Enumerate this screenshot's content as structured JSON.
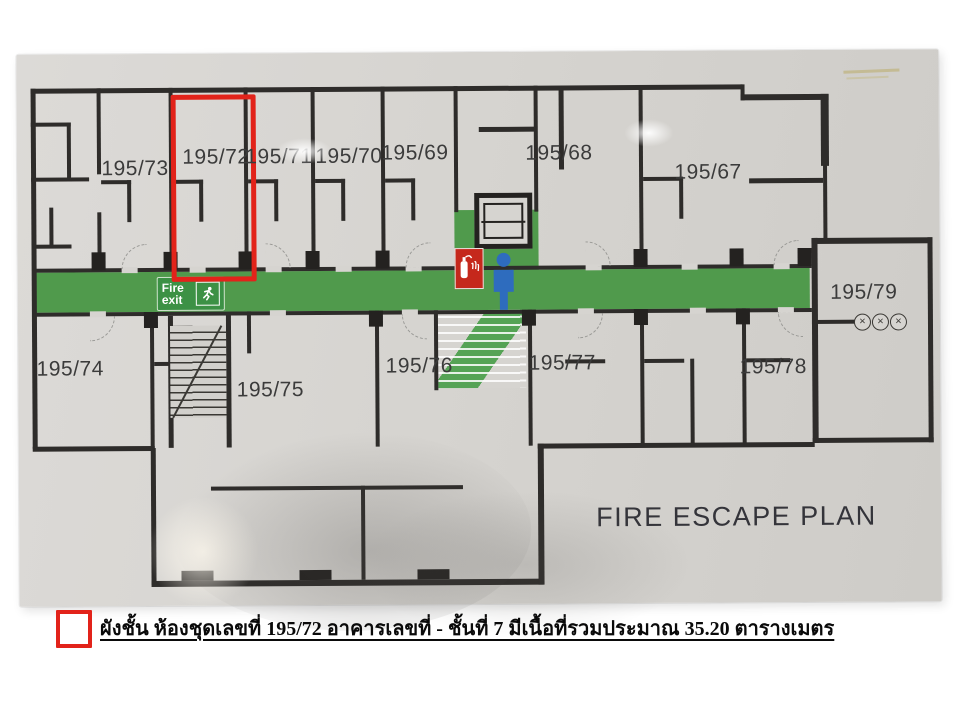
{
  "photo": {
    "title": "FIRE ESCAPE PLAN",
    "highlighted_unit": "195/72",
    "rooms": [
      {
        "label": "195/73"
      },
      {
        "label": "195/72"
      },
      {
        "label": "195/71"
      },
      {
        "label": "195/70"
      },
      {
        "label": "195/69"
      },
      {
        "label": "195/68"
      },
      {
        "label": "195/67"
      },
      {
        "label": "195/79"
      },
      {
        "label": "195/74"
      },
      {
        "label": "195/75"
      },
      {
        "label": "195/76"
      },
      {
        "label": "195/77"
      },
      {
        "label": "195/78"
      }
    ],
    "fire_exit_sign": {
      "line1": "Fire",
      "line2": "exit"
    },
    "window_symbol": "×"
  },
  "legend": {
    "caption": "ผังชั้น ห้องชุดเลขที่ 195/72 อาคารเลขที่ - ชั้นที่ 7  มีเนื้อที่รวมประมาณ 35.20 ตารางเมตร"
  },
  "colors": {
    "escape_route_green": "#509a4c",
    "highlight_red": "#e2231a",
    "person_blue": "#2e6cbe",
    "extinguisher_red": "#c5281c",
    "wall_black": "#2e2c2a"
  }
}
